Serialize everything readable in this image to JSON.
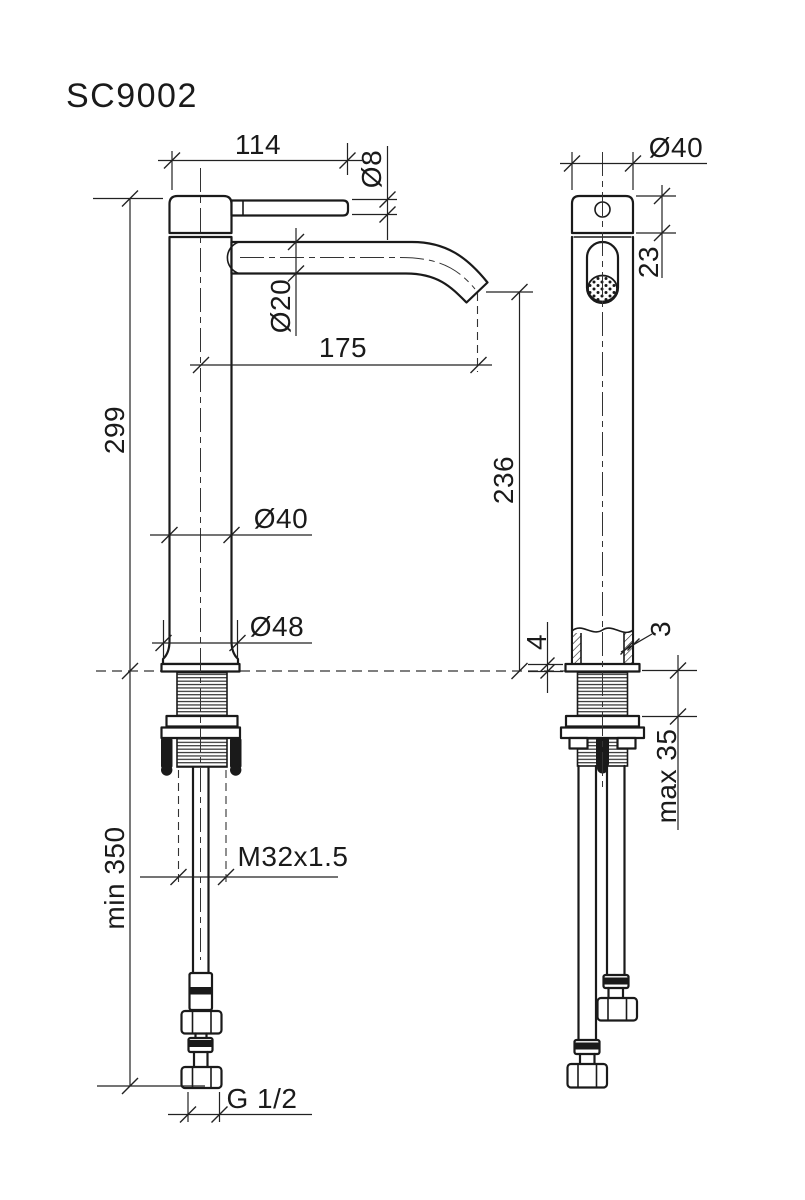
{
  "drawing": {
    "title": "SC9002",
    "front_view": {
      "handle_length": "114",
      "handle_diameter": "Ø8",
      "spout_diameter": "Ø20",
      "spout_reach": "175",
      "body_height": "299",
      "outlet_height": "236",
      "body_diameter": "Ø40",
      "base_diameter": "Ø48",
      "min_hose_length": "min 350",
      "mounting_thread": "M32x1.5",
      "connection_thread": "G 1/2"
    },
    "side_view": {
      "body_diameter": "Ø40",
      "top_section_height": "23",
      "wall_thickness": "3",
      "base_plate_height": "4",
      "max_deck_thickness": "max 35"
    }
  }
}
